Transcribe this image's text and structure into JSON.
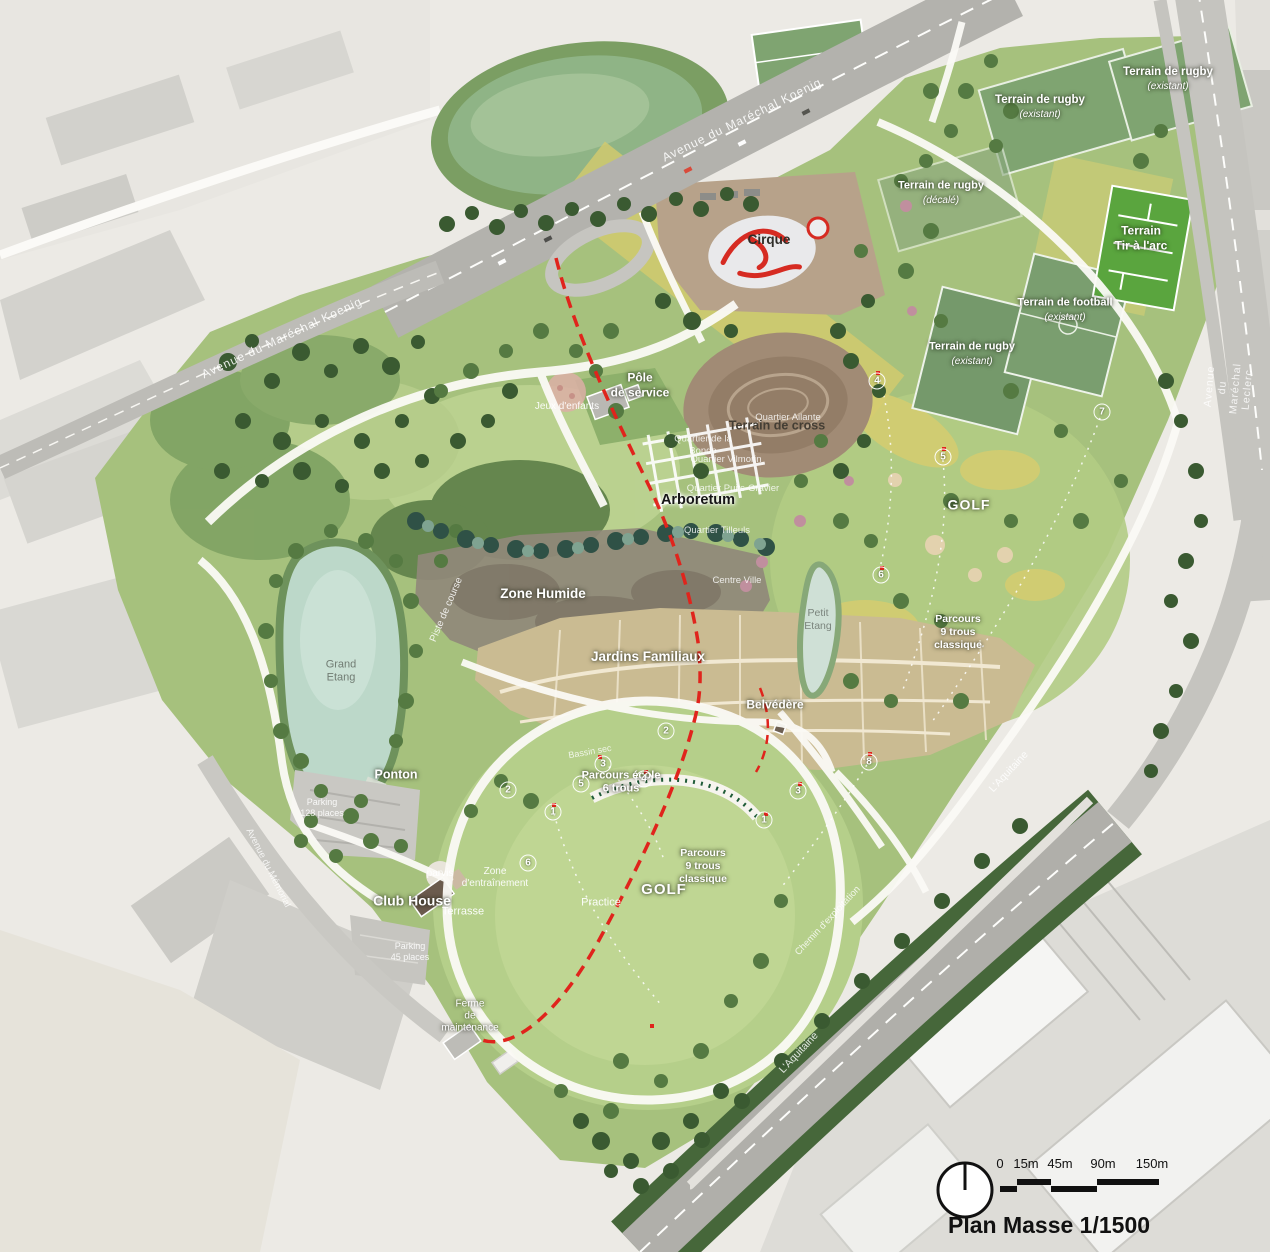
{
  "map": {
    "title": "Plan Masse 1/1500",
    "scale_ticks": [
      "0",
      "15m",
      "45m",
      "90m",
      "150m"
    ],
    "colors": {
      "park_green": "#a6c17d",
      "field_green": "#7fa471",
      "water": "#bcd8c9",
      "sand_yellow": "#d5cb6d",
      "wet_zone": "#90897a",
      "allotments": "#cabb92",
      "red_dashed": "#e0241c",
      "road_grey": "#b3b2ad",
      "urban": "#e8e6e1"
    },
    "labels": [
      {
        "name": "road-label-koenig-top",
        "text": "Avenue du Maréchal Koenig",
        "x": 742,
        "y": 120,
        "rot": -26,
        "size": 12,
        "color": "rgba(255,255,255,0.88)",
        "ls": 1
      },
      {
        "name": "road-label-koenig-left",
        "text": "Avenue du Maréchal Koenig",
        "x": 282,
        "y": 338,
        "rot": -25,
        "size": 12,
        "color": "rgba(255,255,255,0.88)",
        "ls": 1
      },
      {
        "name": "road-label-leclerc",
        "text": "Avenue du Maréchal Leclerc",
        "x": 1229,
        "y": 388,
        "rot": -85,
        "size": 10.5,
        "color": "rgba(255,255,255,0.82)",
        "ls": 1
      },
      {
        "name": "road-label-memorial",
        "text": "Avenue du Mémorial",
        "x": 268,
        "y": 868,
        "rot": 63,
        "size": 9.5,
        "color": "rgba(255,255,255,0.8)"
      },
      {
        "name": "field-label-rugby-1",
        "text": "Terrain de rugby",
        "x": 1040,
        "y": 100,
        "size": 11.5,
        "color": "#fff",
        "bold": true,
        "halo": "dark"
      },
      {
        "name": "field-status-rugby-1",
        "text": "(existant)",
        "x": 1040,
        "y": 115,
        "size": 10,
        "color": "#fff",
        "italic": true,
        "halo": "dark"
      },
      {
        "name": "field-label-rugby-2",
        "text": "Terrain de rugby",
        "x": 1168,
        "y": 72,
        "size": 11.5,
        "color": "#fff",
        "bold": true,
        "halo": "dark"
      },
      {
        "name": "field-status-rugby-2",
        "text": "(existant)",
        "x": 1168,
        "y": 87,
        "size": 10,
        "color": "#fff",
        "italic": true,
        "halo": "dark"
      },
      {
        "name": "field-label-rugby-3",
        "text": "Terrain de rugby",
        "x": 941,
        "y": 186,
        "size": 11,
        "color": "#fff",
        "bold": true,
        "halo": "dark"
      },
      {
        "name": "field-status-rugby-3",
        "text": "(décalé)",
        "x": 941,
        "y": 201,
        "size": 10,
        "color": "#fff",
        "italic": true,
        "halo": "dark"
      },
      {
        "name": "field-label-rugby-4",
        "text": "Terrain de rugby",
        "x": 972,
        "y": 347,
        "size": 11,
        "color": "#fff",
        "bold": true,
        "halo": "dark"
      },
      {
        "name": "field-status-rugby-4",
        "text": "(existant)",
        "x": 972,
        "y": 362,
        "size": 10,
        "color": "#fff",
        "italic": true,
        "halo": "dark"
      },
      {
        "name": "field-label-football",
        "text": "Terrain de football",
        "x": 1065,
        "y": 303,
        "size": 11,
        "color": "#fff",
        "bold": true,
        "halo": "dark"
      },
      {
        "name": "field-status-football",
        "text": "(existant)",
        "x": 1065,
        "y": 318,
        "size": 10,
        "color": "#fff",
        "italic": true,
        "halo": "dark"
      },
      {
        "name": "field-label-tir-arc",
        "text": "Terrain\nTir à l'arc",
        "x": 1141,
        "y": 238,
        "size": 12,
        "color": "#fff",
        "bold": true,
        "halo": "dark"
      },
      {
        "name": "area-label-cirque",
        "text": "Cirque",
        "x": 769,
        "y": 240,
        "size": 13.5,
        "color": "#2f2d28",
        "bold": true
      },
      {
        "name": "area-label-cross",
        "text": "Terrain de cross",
        "x": 777,
        "y": 426,
        "size": 12.5,
        "color": "#443e34",
        "bold": true
      },
      {
        "name": "area-label-pole-service",
        "text": "Pôle\nde service",
        "x": 640,
        "y": 385,
        "size": 12,
        "color": "#fff",
        "bold": true,
        "halo": "dark"
      },
      {
        "name": "area-label-jeux-enfants",
        "text": "Jeux d'enfants",
        "x": 567,
        "y": 407,
        "size": 10,
        "color": "rgba(255,255,255,0.92)"
      },
      {
        "name": "quartier-label-bonde",
        "text": "Quartier de la\nBonde",
        "x": 703,
        "y": 445,
        "size": 9.5,
        "color": "rgba(255,255,255,0.82)"
      },
      {
        "name": "quartier-label-ailante",
        "text": "Quartier Ailante",
        "x": 788,
        "y": 418,
        "size": 9.5,
        "color": "rgba(255,255,255,0.82)"
      },
      {
        "name": "quartier-label-vilmorin",
        "text": "Quartier Vilmorin",
        "x": 726,
        "y": 460,
        "size": 9.5,
        "color": "rgba(255,255,255,0.82)"
      },
      {
        "name": "quartier-label-puits-gravier",
        "text": "Quartier Puits-Gravier",
        "x": 733,
        "y": 489,
        "size": 9.5,
        "color": "rgba(255,255,255,0.82)"
      },
      {
        "name": "area-label-arboretum",
        "text": "Arboretum",
        "x": 698,
        "y": 501,
        "size": 14.5,
        "color": "#161616",
        "bold": true,
        "halo": "light"
      },
      {
        "name": "quartier-label-tilleuls",
        "text": "Quartier Tilleuls",
        "x": 717,
        "y": 531,
        "size": 9.5,
        "color": "rgba(255,255,255,0.82)"
      },
      {
        "name": "quartier-label-centre-ville",
        "text": "Centre Ville",
        "x": 737,
        "y": 581,
        "size": 9.5,
        "color": "rgba(255,255,255,0.82)"
      },
      {
        "name": "area-label-zone-humide",
        "text": "Zone Humide",
        "x": 543,
        "y": 594,
        "size": 13.5,
        "color": "#fff",
        "bold": true,
        "halo": "dark"
      },
      {
        "name": "path-label-piste-course",
        "text": "Piste de course",
        "x": 447,
        "y": 610,
        "rot": -67,
        "size": 10,
        "color": "rgba(255,255,255,0.85)"
      },
      {
        "name": "area-label-jardins-familiaux",
        "text": "Jardins Familiaux",
        "x": 648,
        "y": 657,
        "size": 13.5,
        "color": "#fff",
        "bold": true,
        "halo": "dark"
      },
      {
        "name": "water-label-grand-etang",
        "text": "Grand\nEtang",
        "x": 341,
        "y": 672,
        "size": 11,
        "color": "rgba(108,118,110,0.95)"
      },
      {
        "name": "area-label-ponton",
        "text": "Ponton",
        "x": 396,
        "y": 775,
        "size": 12.5,
        "color": "#fff",
        "bold": true,
        "halo": "dark"
      },
      {
        "name": "area-label-parking-ouest",
        "text": "Parking\n128 places",
        "x": 322,
        "y": 808,
        "size": 9,
        "color": "rgba(255,255,255,0.88)"
      },
      {
        "name": "water-label-petit-etang",
        "text": "Petit\nEtang",
        "x": 818,
        "y": 620,
        "size": 10.5,
        "color": "rgba(118,128,120,0.95)"
      },
      {
        "name": "area-label-golf-est",
        "text": "GOLF",
        "x": 969,
        "y": 505,
        "size": 14,
        "color": "#fff",
        "bold": true,
        "halo": "dark",
        "ls": 1
      },
      {
        "name": "area-label-parcours-9-est",
        "text": "Parcours\n9 trous\nclassique",
        "x": 958,
        "y": 632,
        "size": 10.5,
        "color": "#fff",
        "bold": true,
        "halo": "dark"
      },
      {
        "name": "area-label-belvedere",
        "text": "Belvédère",
        "x": 775,
        "y": 705,
        "size": 12,
        "color": "#fff",
        "bold": true,
        "halo": "dark"
      },
      {
        "name": "area-label-parcours-ecole",
        "text": "Parcours école\n6 trous",
        "x": 621,
        "y": 783,
        "size": 11,
        "color": "#fff",
        "bold": true,
        "halo": "dark"
      },
      {
        "name": "area-label-bassin-sec",
        "text": "Bassin sec",
        "x": 590,
        "y": 752,
        "rot": -10,
        "size": 9,
        "color": "rgba(255,255,255,0.8)"
      },
      {
        "name": "area-label-practice",
        "text": "Practice",
        "x": 601,
        "y": 903,
        "size": 11,
        "color": "rgba(255,255,255,0.95)"
      },
      {
        "name": "area-label-golf-ouest",
        "text": "GOLF",
        "x": 664,
        "y": 890,
        "size": 15,
        "color": "#fff",
        "bold": true,
        "halo": "dark",
        "ls": 1
      },
      {
        "name": "area-label-parcours-9-ouest",
        "text": "Parcours\n9 trous\nclassique",
        "x": 703,
        "y": 866,
        "size": 10.5,
        "color": "#fff",
        "bold": true,
        "halo": "dark"
      },
      {
        "name": "area-label-zone-entrainement",
        "text": "Zone\nd'entraînement",
        "x": 495,
        "y": 878,
        "size": 10,
        "color": "rgba(255,255,255,0.92)"
      },
      {
        "name": "area-label-parvis",
        "text": "parvis",
        "x": 440,
        "y": 874,
        "size": 10,
        "color": "rgba(255,255,255,0.92)"
      },
      {
        "name": "area-label-club-house",
        "text": "Club House",
        "x": 412,
        "y": 901,
        "size": 14,
        "color": "#fff",
        "bold": true,
        "halo": "dark"
      },
      {
        "name": "area-label-terrasse",
        "text": "Terrasse",
        "x": 463,
        "y": 912,
        "size": 11,
        "color": "rgba(255,255,255,0.95)"
      },
      {
        "name": "area-label-parking-club",
        "text": "Parking\n45 places",
        "x": 410,
        "y": 952,
        "size": 9,
        "color": "rgba(255,255,255,0.88)"
      },
      {
        "name": "area-label-ferme-maintenance",
        "text": "Ferme\nde\nmaintenance",
        "x": 470,
        "y": 1017,
        "size": 10,
        "color": "#fff",
        "halo": "dark"
      },
      {
        "name": "road-label-chemin-exploitation",
        "text": "Chemin d'exploitation",
        "x": 828,
        "y": 921,
        "rot": -47,
        "size": 9.5,
        "color": "rgba(255,255,255,0.82)"
      },
      {
        "name": "road-label-aquitaine-1",
        "text": "L'Aquitaine",
        "x": 1009,
        "y": 772,
        "rot": -47,
        "size": 10.5,
        "color": "rgba(255,255,255,0.85)"
      },
      {
        "name": "road-label-aquitaine-2",
        "text": "L'Aquitaine",
        "x": 799,
        "y": 1053,
        "rot": -47,
        "size": 10.5,
        "color": "rgba(255,255,255,0.85)"
      }
    ],
    "golf_holes": [
      {
        "n": "1",
        "x": 553,
        "y": 812
      },
      {
        "n": "2",
        "x": 508,
        "y": 790
      },
      {
        "n": "3",
        "x": 603,
        "y": 764
      },
      {
        "n": "4",
        "x": 644,
        "y": 779
      },
      {
        "n": "5",
        "x": 581,
        "y": 784
      },
      {
        "n": "6",
        "x": 528,
        "y": 863
      },
      {
        "n": "1",
        "x": 764,
        "y": 820
      },
      {
        "n": "2",
        "x": 666,
        "y": 731
      },
      {
        "n": "3",
        "x": 798,
        "y": 791
      },
      {
        "n": "4",
        "x": 877,
        "y": 381
      },
      {
        "n": "5",
        "x": 943,
        "y": 457
      },
      {
        "n": "6",
        "x": 881,
        "y": 575
      },
      {
        "n": "7",
        "x": 1102,
        "y": 412
      },
      {
        "n": "8",
        "x": 869,
        "y": 762
      }
    ]
  }
}
